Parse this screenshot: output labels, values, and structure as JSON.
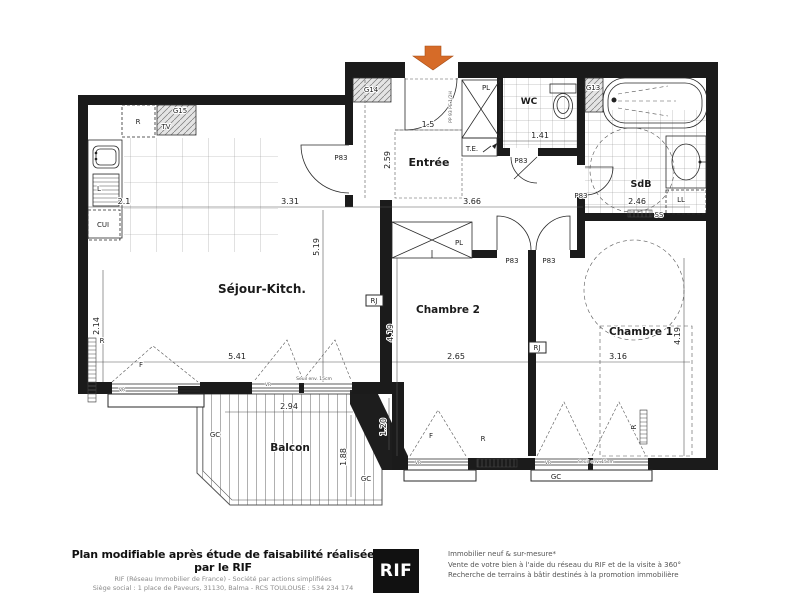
{
  "plan": {
    "entrance_arrow_color": "#d66b28",
    "rooms": [
      {
        "label": "Séjour-Kitch.",
        "x": 262,
        "y": 293,
        "size": 12
      },
      {
        "label": "Entrée",
        "x": 429,
        "y": 166,
        "size": 11
      },
      {
        "label": "WC",
        "x": 529,
        "y": 104,
        "size": 9
      },
      {
        "label": "SdB",
        "x": 641,
        "y": 187,
        "size": 9.5
      },
      {
        "label": "Chambre 2",
        "x": 448,
        "y": 313,
        "size": 10.5
      },
      {
        "label": "Chambre 1",
        "x": 641,
        "y": 335,
        "size": 10.5
      },
      {
        "label": "Balcon",
        "x": 290,
        "y": 451,
        "size": 10.5
      }
    ],
    "dimensions": [
      {
        "label": "2.1",
        "x": 124,
        "y": 204,
        "rot": 0
      },
      {
        "label": "3.31",
        "x": 290,
        "y": 204,
        "rot": 0
      },
      {
        "label": "3.66",
        "x": 472,
        "y": 204,
        "rot": 0
      },
      {
        "label": "1.5",
        "x": 428,
        "y": 127,
        "rot": 0
      },
      {
        "label": "2.59",
        "x": 390,
        "y": 160,
        "rot": -90
      },
      {
        "label": "5.19",
        "x": 319,
        "y": 247,
        "rot": -90
      },
      {
        "label": "2.14",
        "x": 99,
        "y": 326,
        "rot": -90
      },
      {
        "label": "5.41",
        "x": 237,
        "y": 359,
        "rot": 0
      },
      {
        "label": "4.19",
        "x": 393,
        "y": 333,
        "rot": -90
      },
      {
        "label": "2.65",
        "x": 456,
        "y": 359,
        "rot": 0
      },
      {
        "label": "3.16",
        "x": 618,
        "y": 359,
        "rot": 0
      },
      {
        "label": "4.19",
        "x": 680,
        "y": 336,
        "rot": -90
      },
      {
        "label": "1.41",
        "x": 540,
        "y": 138,
        "rot": 0
      },
      {
        "label": "2.46",
        "x": 637,
        "y": 204,
        "rot": 0
      },
      {
        "label": "2.94",
        "x": 289,
        "y": 409,
        "rot": 0
      },
      {
        "label": "1.88",
        "x": 346,
        "y": 457,
        "rot": -90
      },
      {
        "label": "1.20",
        "x": 386,
        "y": 427,
        "rot": -90
      }
    ],
    "tags": [
      {
        "label": "R",
        "x": 138,
        "y": 124
      },
      {
        "label": "TV",
        "x": 166,
        "y": 129
      },
      {
        "label": "G15",
        "x": 180,
        "y": 113
      },
      {
        "label": "G14",
        "x": 371,
        "y": 92
      },
      {
        "label": "L",
        "x": 99,
        "y": 191
      },
      {
        "label": "CUI",
        "x": 103,
        "y": 227
      },
      {
        "label": "PL",
        "x": 486,
        "y": 90
      },
      {
        "label": "T.E.",
        "x": 472,
        "y": 151
      },
      {
        "label": "G13",
        "x": 593,
        "y": 90
      },
      {
        "label": "PL",
        "x": 459,
        "y": 245
      },
      {
        "label": "P83",
        "x": 341,
        "y": 160
      },
      {
        "label": "P83",
        "x": 521,
        "y": 163
      },
      {
        "label": "P83",
        "x": 581,
        "y": 198
      },
      {
        "label": "P83",
        "x": 512,
        "y": 263
      },
      {
        "label": "P83",
        "x": 549,
        "y": 263
      },
      {
        "label": "RJ",
        "x": 374,
        "y": 303
      },
      {
        "label": "RJ",
        "x": 537,
        "y": 350
      },
      {
        "label": "LL",
        "x": 681,
        "y": 202
      },
      {
        "label": "SS",
        "x": 659,
        "y": 217
      },
      {
        "label": "R",
        "x": 102,
        "y": 343
      },
      {
        "label": "F",
        "x": 141,
        "y": 367
      },
      {
        "label": "VR",
        "x": 122,
        "y": 391,
        "tiny": true
      },
      {
        "label": "VR",
        "x": 268,
        "y": 386,
        "tiny": true
      },
      {
        "label": "Seuil env. 15cm",
        "x": 314,
        "y": 380,
        "tiny": true
      },
      {
        "label": "F",
        "x": 431,
        "y": 438
      },
      {
        "label": "VR",
        "x": 418,
        "y": 464,
        "tiny": true
      },
      {
        "label": "R",
        "x": 483,
        "y": 441
      },
      {
        "label": "VR",
        "x": 548,
        "y": 464,
        "tiny": true
      },
      {
        "label": "Seuil env. 15cm",
        "x": 596,
        "y": 463,
        "tiny": true
      },
      {
        "label": "R",
        "x": 636,
        "y": 427,
        "rot": -90
      },
      {
        "label": "GC",
        "x": 215,
        "y": 437
      },
      {
        "label": "GC",
        "x": 366,
        "y": 481
      },
      {
        "label": "GC",
        "x": 556,
        "y": 479
      },
      {
        "label": "PP 93 PE 1/2H",
        "x": 452,
        "y": 107,
        "rot": -90,
        "tiny": true
      }
    ]
  },
  "footer": {
    "disclaimer": "Plan modifiable après étude de faisabilité réalisée par le RIF",
    "company_line1": "RIF (Réseau Immobilier de France) - Société par actions simplifiées",
    "company_line2": "Siège social : 1 place de Paveurs, 31130, Balma - RCS TOULOUSE : 534 234 174",
    "logo_text": "RIF",
    "services": [
      "Immobilier neuf & sur-mesure*",
      "Vente de votre bien à l'aide du réseau du RIF et de la visite à 360°",
      "Recherche de terrains à bâtir destinés à la promotion immobilière"
    ]
  }
}
